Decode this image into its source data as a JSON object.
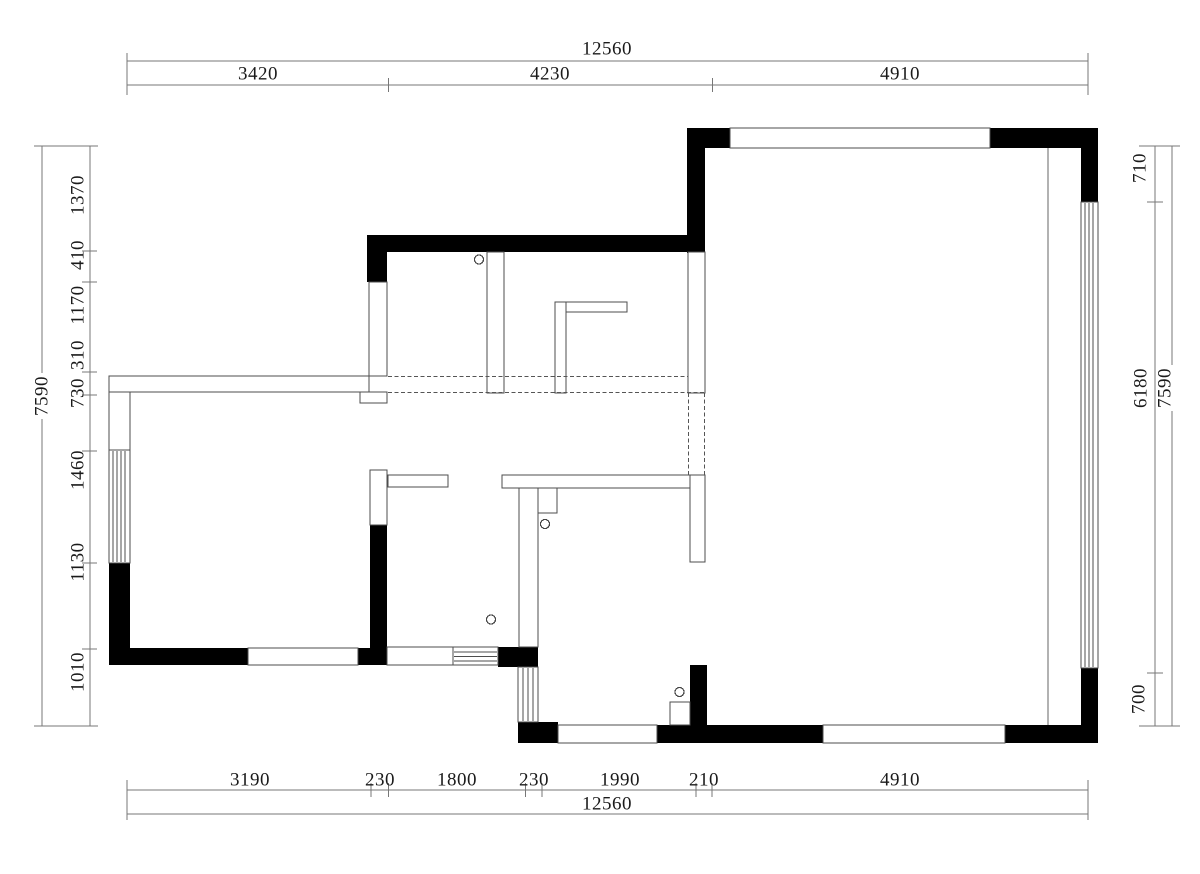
{
  "dimensions": {
    "top": {
      "total": "12560",
      "segments": [
        "3420",
        "4230",
        "4910"
      ]
    },
    "bottom": {
      "total": "12560",
      "segments": [
        "3190",
        "230",
        "1800",
        "230",
        "1990",
        "210",
        "4910"
      ]
    },
    "left": {
      "total": "7590",
      "segments": [
        "1370",
        "410",
        "1170",
        "310",
        "730",
        "1460",
        "1130",
        "1010"
      ]
    },
    "right": {
      "total": "7590",
      "segments": [
        "710",
        "6180",
        "700"
      ]
    }
  },
  "colors": {
    "wall": "#000000",
    "outline": "#4d4d4d",
    "dimension_line": "#777777",
    "background": "#ffffff"
  }
}
